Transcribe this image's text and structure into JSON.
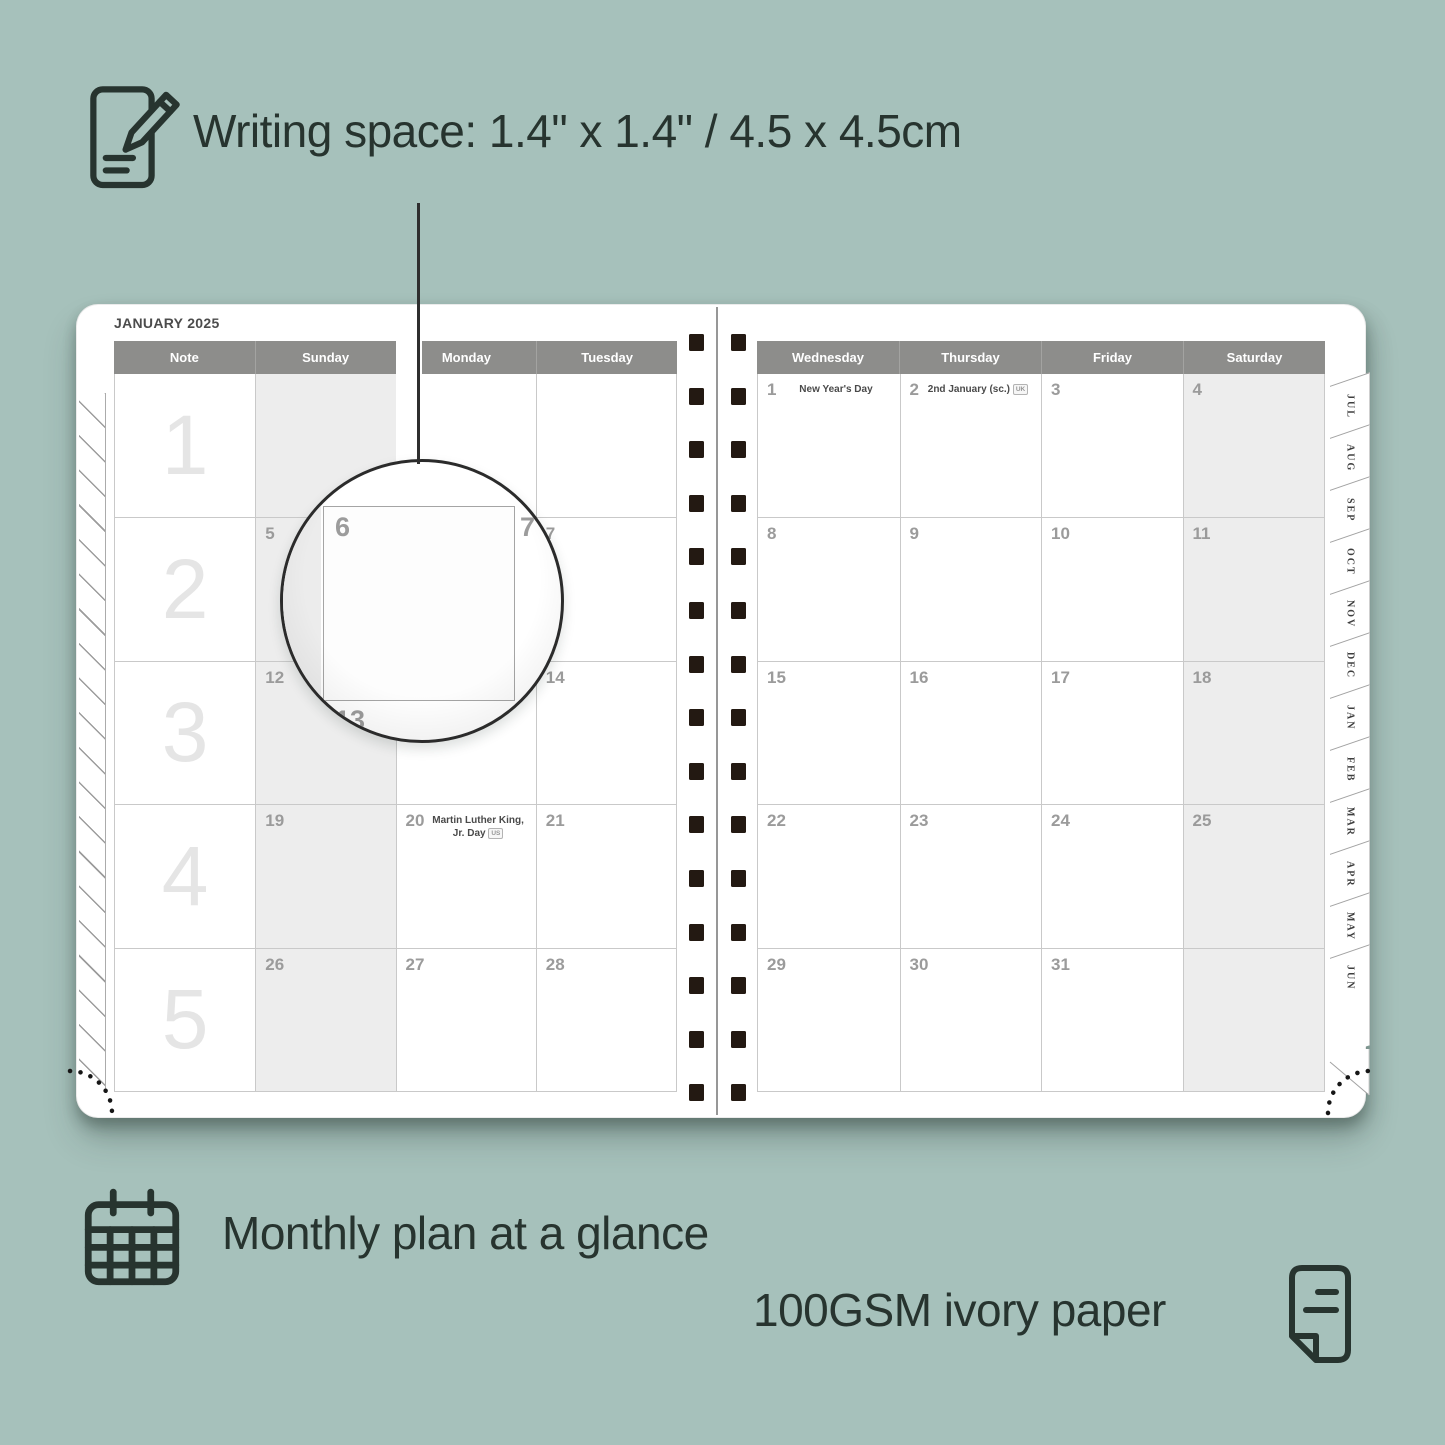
{
  "colors": {
    "background": "#a6c1bb",
    "ink": "#27342f",
    "header_gray": "#8d8d8b",
    "weekend_shade": "#ededed",
    "spiral_dark": "#231912"
  },
  "annotations": {
    "writing_space": "Writing space: 1.4\" x 1.4\" / 4.5 x 4.5cm",
    "monthly_plan": "Monthly plan at a glance",
    "paper": "100GSM ivory paper"
  },
  "planner": {
    "title": "JANUARY 2025",
    "left_headers": [
      "Note",
      "Sunday",
      "Monday",
      "Tuesday"
    ],
    "right_headers": [
      "Wednesday",
      "Thursday",
      "Friday",
      "Saturday"
    ],
    "week_numbers": [
      "1",
      "2",
      "3",
      "4",
      "5"
    ],
    "left_days": [
      [
        "",
        "",
        ""
      ],
      [
        "5",
        "6",
        "7"
      ],
      [
        "12",
        "13",
        "14"
      ],
      [
        "19",
        "20",
        "21"
      ],
      [
        "26",
        "27",
        "28"
      ]
    ],
    "right_days": [
      [
        "1",
        "2",
        "3",
        "4"
      ],
      [
        "8",
        "9",
        "10",
        "11"
      ],
      [
        "15",
        "16",
        "17",
        "18"
      ],
      [
        "22",
        "23",
        "24",
        "25"
      ],
      [
        "29",
        "30",
        "31",
        ""
      ]
    ],
    "holidays": [
      {
        "page": "left",
        "row": 3,
        "col": 1,
        "text": "Martin Luther King, Jr. Day",
        "badge": "US"
      },
      {
        "page": "right",
        "row": 0,
        "col": 0,
        "text": "New Year's Day",
        "badge": ""
      },
      {
        "page": "right",
        "row": 0,
        "col": 1,
        "text": "2nd January (sc.)",
        "badge": "UK"
      }
    ],
    "tabs": [
      "JUL",
      "AUG",
      "SEP",
      "OCT",
      "NOV",
      "DEC",
      "JAN",
      "FEB",
      "MAR",
      "APR",
      "MAY",
      "JUN"
    ],
    "lens": {
      "day": "6",
      "right_day": "7",
      "below_day": "13"
    },
    "spiral_count": 15
  }
}
